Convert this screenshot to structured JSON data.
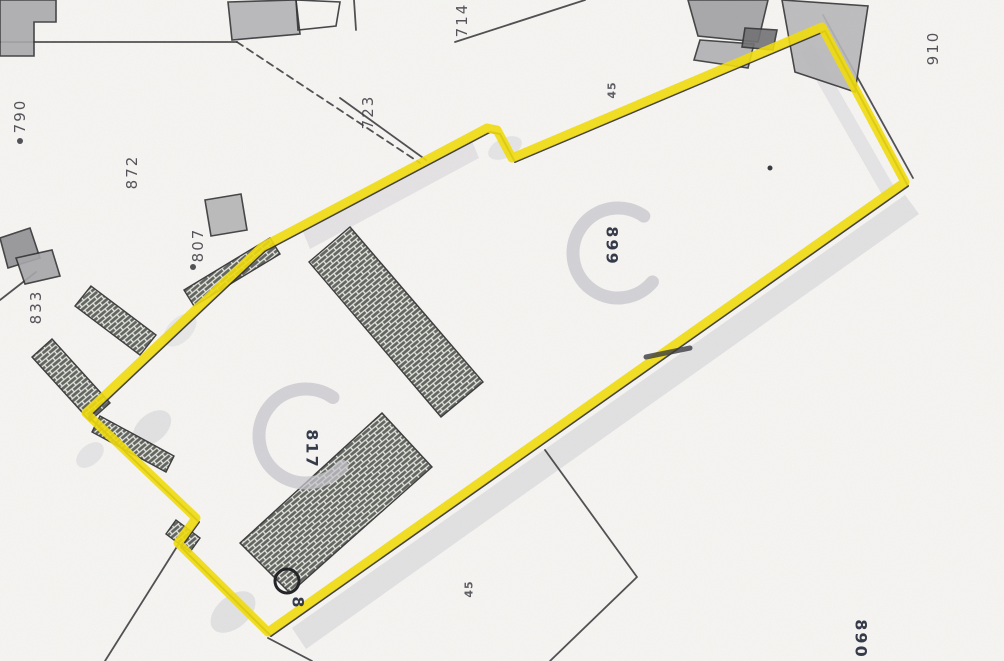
{
  "map": {
    "type": "scanned-cadastral-plan-with-highlighted-parcel",
    "background": "#f7f6f3",
    "highlight_color": "#f2dd05",
    "line_color": "#2e2e30",
    "printed_label_color": "#3f3f46",
    "pen_label_color": "#262c3c",
    "gray_mark_color": "#c7c6cc",
    "labels": [
      {
        "text": "714",
        "x": 462,
        "y": 20,
        "rot": -90,
        "style": "printed"
      },
      {
        "text": "723",
        "x": 368,
        "y": 112,
        "rot": -90,
        "style": "printed"
      },
      {
        "text": "790",
        "x": 20,
        "y": 116,
        "rot": -90,
        "style": "printed",
        "dot": {
          "x": 20,
          "y": 141
        }
      },
      {
        "text": "872",
        "x": 132,
        "y": 172,
        "rot": -90,
        "style": "printed"
      },
      {
        "text": "807",
        "x": 198,
        "y": 245,
        "rot": -90,
        "style": "printed",
        "dot": {
          "x": 193,
          "y": 267
        }
      },
      {
        "text": "833",
        "x": 36,
        "y": 307,
        "rot": -90,
        "style": "printed"
      },
      {
        "text": "910",
        "x": 933,
        "y": 48,
        "rot": -90,
        "style": "printed"
      },
      {
        "text": "45",
        "x": 612,
        "y": 90,
        "rot": -90,
        "style": "printed-small"
      },
      {
        "text": "45",
        "x": 469,
        "y": 589,
        "rot": -90,
        "style": "printed-small"
      },
      {
        "text": "899",
        "x": 612,
        "y": 246,
        "rot": 90,
        "style": "pen"
      },
      {
        "text": "817",
        "x": 312,
        "y": 449,
        "rot": 90,
        "style": "pen"
      },
      {
        "text": "890",
        "x": 861,
        "y": 639,
        "rot": 90,
        "style": "pen"
      },
      {
        "text": "8",
        "x": 298,
        "y": 603,
        "rot": 90,
        "style": "pen"
      }
    ],
    "highlight_polygon": [
      [
        262,
        247
      ],
      [
        487,
        128
      ],
      [
        497,
        130
      ],
      [
        512,
        158
      ],
      [
        822,
        27
      ],
      [
        905,
        182
      ],
      [
        268,
        632
      ],
      [
        178,
        543
      ],
      [
        196,
        518
      ],
      [
        86,
        413
      ]
    ],
    "black_lines": [
      {
        "points": [
          [
            0,
            42
          ],
          [
            237,
            42
          ]
        ],
        "dashed": false
      },
      {
        "points": [
          [
            237,
            42
          ],
          [
            420,
            163
          ]
        ],
        "dashed": true
      },
      {
        "points": [
          [
            340,
            98
          ],
          [
            426,
            160
          ]
        ],
        "dashed": false
      },
      {
        "points": [
          [
            354,
            0
          ],
          [
            356,
            30
          ]
        ],
        "dashed": false
      },
      {
        "points": [
          [
            455,
            42
          ],
          [
            585,
            0
          ]
        ],
        "dashed": false
      },
      {
        "points": [
          [
            823,
            15
          ],
          [
            913,
            178
          ]
        ],
        "dashed": false
      },
      {
        "points": [
          [
            545,
            450
          ],
          [
            637,
            577
          ],
          [
            550,
            661
          ]
        ],
        "dashed": false
      },
      {
        "points": [
          [
            268,
            638
          ],
          [
            312,
            661
          ]
        ],
        "dashed": false
      },
      {
        "points": [
          [
            178,
            545
          ],
          [
            105,
            661
          ]
        ],
        "dashed": false
      },
      {
        "points": [
          [
            0,
            300
          ],
          [
            36,
            272
          ]
        ],
        "dashed": false
      }
    ],
    "buildings": [
      {
        "points": [
          [
            0,
            0
          ],
          [
            56,
            0
          ],
          [
            56,
            22
          ],
          [
            34,
            22
          ],
          [
            34,
            56
          ],
          [
            0,
            56
          ]
        ],
        "fill": "#a9a9ab"
      },
      {
        "points": [
          [
            228,
            2
          ],
          [
            296,
            0
          ],
          [
            300,
            34
          ],
          [
            232,
            40
          ]
        ],
        "fill": "#b3b3b5"
      },
      {
        "points": [
          [
            296,
            0
          ],
          [
            340,
            2
          ],
          [
            336,
            26
          ],
          [
            298,
            30
          ]
        ],
        "fill": "none"
      },
      {
        "points": [
          [
            688,
            0
          ],
          [
            768,
            0
          ],
          [
            758,
            42
          ],
          [
            698,
            36
          ]
        ],
        "fill": "#9f9fa1"
      },
      {
        "points": [
          [
            700,
            40
          ],
          [
            754,
            44
          ],
          [
            748,
            68
          ],
          [
            694,
            60
          ]
        ],
        "fill": "#b0b0b2"
      },
      {
        "points": [
          [
            782,
            0
          ],
          [
            868,
            6
          ],
          [
            855,
            92
          ],
          [
            795,
            72
          ]
        ],
        "fill": "#b7b7b9"
      },
      {
        "points": [
          [
            745,
            28
          ],
          [
            777,
            30
          ],
          [
            773,
            50
          ],
          [
            742,
            47
          ]
        ],
        "fill": "#6f6f72"
      },
      {
        "points": [
          [
            205,
            200
          ],
          [
            241,
            194
          ],
          [
            247,
            230
          ],
          [
            211,
            236
          ]
        ],
        "fill": "#b4b4b6"
      },
      {
        "points": [
          [
            0,
            238
          ],
          [
            30,
            228
          ],
          [
            40,
            258
          ],
          [
            8,
            268
          ]
        ],
        "fill": "#8f8f92"
      },
      {
        "points": [
          [
            16,
            258
          ],
          [
            52,
            250
          ],
          [
            60,
            276
          ],
          [
            25,
            284
          ]
        ],
        "fill": "#a6a6a9"
      }
    ],
    "hatched_areas": [
      {
        "points": [
          [
            184,
            290
          ],
          [
            270,
            238
          ],
          [
            280,
            254
          ],
          [
            194,
            306
          ]
        ]
      },
      {
        "points": [
          [
            91,
            286
          ],
          [
            156,
            335
          ],
          [
            140,
            355
          ],
          [
            75,
            306
          ]
        ]
      },
      {
        "points": [
          [
            52,
            339
          ],
          [
            110,
            403
          ],
          [
            90,
            421
          ],
          [
            32,
            357
          ]
        ]
      },
      {
        "points": [
          [
            100,
            416
          ],
          [
            174,
            456
          ],
          [
            166,
            472
          ],
          [
            92,
            432
          ]
        ]
      },
      {
        "points": [
          [
            350,
            227
          ],
          [
            483,
            382
          ],
          [
            441,
            417
          ],
          [
            309,
            262
          ]
        ]
      },
      {
        "points": [
          [
            382,
            413
          ],
          [
            432,
            467
          ],
          [
            290,
            593
          ],
          [
            240,
            543
          ]
        ]
      },
      {
        "points": [
          [
            176,
            520
          ],
          [
            200,
            538
          ],
          [
            190,
            552
          ],
          [
            166,
            534
          ]
        ]
      }
    ],
    "shadows": [
      {
        "kind": "poly",
        "points": [
          [
            905,
            195
          ],
          [
            292,
            628
          ],
          [
            306,
            649
          ],
          [
            919,
            214
          ]
        ],
        "opacity": 0.5
      },
      {
        "kind": "poly",
        "points": [
          [
            303,
            232
          ],
          [
            472,
            141
          ],
          [
            479,
            158
          ],
          [
            310,
            249
          ]
        ],
        "opacity": 0.45
      },
      {
        "kind": "poly",
        "points": [
          [
            812,
            44
          ],
          [
            896,
            190
          ],
          [
            884,
            198
          ],
          [
            800,
            52
          ]
        ],
        "opacity": 0.4
      },
      {
        "kind": "ellipse",
        "cx": 152,
        "cy": 428,
        "rx": 22,
        "ry": 14,
        "rot": -40,
        "opacity": 0.5
      },
      {
        "kind": "ellipse",
        "cx": 233,
        "cy": 612,
        "rx": 26,
        "ry": 16,
        "rot": -40,
        "opacity": 0.5
      },
      {
        "kind": "ellipse",
        "cx": 90,
        "cy": 455,
        "rx": 16,
        "ry": 10,
        "rot": -40,
        "opacity": 0.4
      },
      {
        "kind": "ellipse",
        "cx": 180,
        "cy": 330,
        "rx": 20,
        "ry": 12,
        "rot": -45,
        "opacity": 0.35
      },
      {
        "kind": "ellipse",
        "cx": 505,
        "cy": 148,
        "rx": 18,
        "ry": 10,
        "rot": -25,
        "opacity": 0.4
      }
    ],
    "g_marks": [
      {
        "cx": 306,
        "cy": 436,
        "r": 47
      },
      {
        "cx": 618,
        "cy": 253,
        "r": 45
      }
    ],
    "pen_marks": {
      "circle": {
        "cx": 287,
        "cy": 581,
        "r": 12
      },
      "dash": {
        "points": [
          [
            646,
            357
          ],
          [
            690,
            348
          ]
        ]
      },
      "dot": {
        "cx": 770,
        "cy": 168,
        "r": 2.5
      }
    }
  }
}
